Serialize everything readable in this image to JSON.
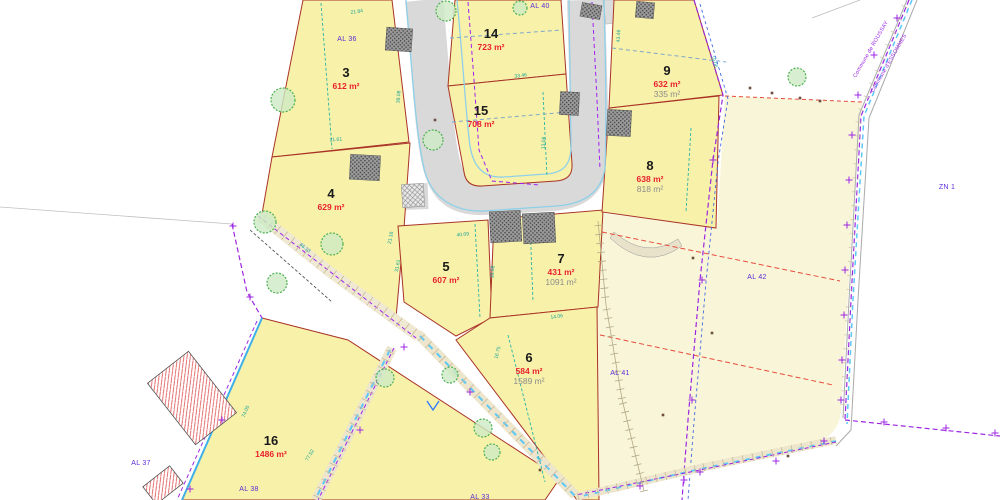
{
  "map": {
    "type": "cadastral-subdivision-plan",
    "parcels": [
      {
        "num": "3",
        "area": "612 m²",
        "x": 346,
        "y": 77
      },
      {
        "num": "4",
        "area": "629 m²",
        "x": 331,
        "y": 198
      },
      {
        "num": "5",
        "area": "607 m²",
        "x": 446,
        "y": 271
      },
      {
        "num": "6",
        "area": "584 m²",
        "area2": "1589 m²",
        "x": 529,
        "y": 362
      },
      {
        "num": "7",
        "area": "431 m²",
        "area2": "1091 m²",
        "x": 561,
        "y": 263
      },
      {
        "num": "8",
        "area": "638 m²",
        "area2": "818 m²",
        "x": 650,
        "y": 170
      },
      {
        "num": "9",
        "area": "632 m²",
        "area2": "335 m²",
        "x": 667,
        "y": 75
      },
      {
        "num": "14",
        "area": "723 m²",
        "x": 491,
        "y": 38
      },
      {
        "num": "15",
        "area": "708 m²",
        "x": 481,
        "y": 115
      },
      {
        "num": "16",
        "area": "1486 m²",
        "x": 271,
        "y": 445
      }
    ],
    "cadastral_refs": [
      {
        "label": "AL 36",
        "x": 347,
        "y": 41
      },
      {
        "label": "AL 40",
        "x": 540,
        "y": 8
      },
      {
        "label": "AL 37",
        "x": 141,
        "y": 465
      },
      {
        "label": "AL 38",
        "x": 249,
        "y": 491
      },
      {
        "label": "AL 33",
        "x": 480,
        "y": 499
      },
      {
        "label": "AL 41",
        "x": 620,
        "y": 375
      },
      {
        "label": "AL 42",
        "x": 757,
        "y": 279
      },
      {
        "label": "ZN 1",
        "x": 947,
        "y": 189
      }
    ],
    "commune_labels": [
      {
        "label": "Commune de ROUSSAY",
        "x": 872,
        "y": 50,
        "r": -60
      },
      {
        "label": "Commune d'ESSOMMES",
        "x": 890,
        "y": 64,
        "r": -60
      }
    ],
    "dimensions": [
      {
        "t": "21.84",
        "x": 357,
        "y": 13,
        "r": -8
      },
      {
        "t": "33.46",
        "x": 521,
        "y": 77,
        "r": -8
      },
      {
        "t": "21.61",
        "x": 336,
        "y": 141,
        "r": -5
      },
      {
        "t": "39.08",
        "x": 400,
        "y": 97,
        "r": -85
      },
      {
        "t": "43.46",
        "x": 620,
        "y": 36,
        "r": -88
      },
      {
        "t": "19.06",
        "x": 713,
        "y": 62,
        "r": 73
      },
      {
        "t": "13.06",
        "x": 545,
        "y": 143,
        "r": -88
      },
      {
        "t": "40.09",
        "x": 463,
        "y": 236,
        "r": -6
      },
      {
        "t": "21.16",
        "x": 392,
        "y": 238,
        "r": -80
      },
      {
        "t": "31.61",
        "x": 399,
        "y": 266,
        "r": -80
      },
      {
        "t": "33.08",
        "x": 494,
        "y": 272,
        "r": -85
      },
      {
        "t": "14.06",
        "x": 557,
        "y": 318,
        "r": -8
      },
      {
        "t": "46.13",
        "x": 304,
        "y": 249,
        "r": 38
      },
      {
        "t": "16.75",
        "x": 499,
        "y": 353,
        "r": -75
      },
      {
        "t": "74.05",
        "x": 247,
        "y": 412,
        "r": -66
      },
      {
        "t": "77.52",
        "x": 311,
        "y": 456,
        "r": -60
      }
    ],
    "colors": {
      "lot_fill": "#f8f1a9",
      "outer_parcel_fill": "#f9f5d8",
      "lot_boundary_red": "#a93226",
      "area_text_red": "#e8212e",
      "secondary_area_grey": "#8c8c8c",
      "cadastral_ref_purple": "#5b2bd6",
      "dimension_teal": "#17a398",
      "boundary_purple": "#9c27e0",
      "road_grey": "#d9d9d9",
      "curb_blue": "#8fd0e8",
      "tree_green": "#4caf50"
    }
  }
}
